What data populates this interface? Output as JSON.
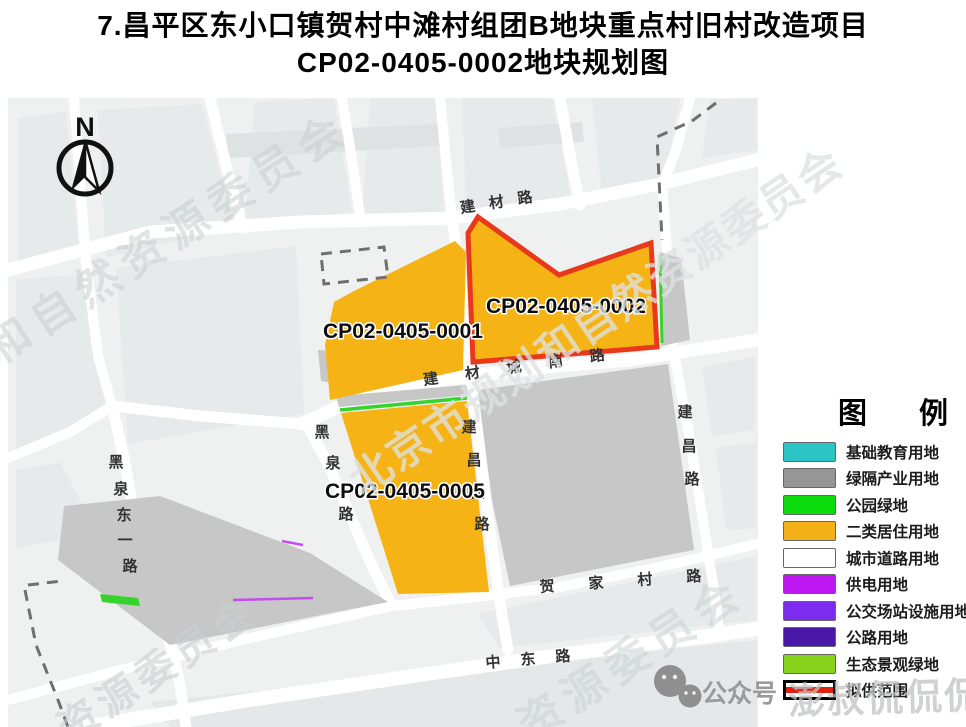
{
  "title": {
    "line1": "7.昌平区东小口镇贺村中滩村组团B地块重点村旧村改造项目",
    "line2": "CP02-0405-0002地块规划图"
  },
  "compass": {
    "north_label": "N"
  },
  "parcels": {
    "p0001": {
      "label": "CP02-0405-0001"
    },
    "p0002": {
      "label": "CP02-0405-0002"
    },
    "p0005": {
      "label": "CP02-0405-0005"
    }
  },
  "roads": {
    "jiancai": {
      "name": "建材路"
    },
    "jiancai_cheng_nan": {
      "name": "建材城南路"
    },
    "hejiacun": {
      "name": "贺家村路"
    },
    "zhongdong": {
      "name": "中东路"
    },
    "heiquan": {
      "chars": [
        "黑",
        "泉",
        "路"
      ]
    },
    "heiquan_dongyi": {
      "chars": [
        "黑",
        "泉",
        "东",
        "一",
        "路"
      ]
    },
    "jianchang_xi": {
      "chars": [
        "建",
        "昌",
        "西",
        "路"
      ]
    },
    "jianchang": {
      "chars": [
        "建",
        "昌",
        "路"
      ]
    }
  },
  "legend": {
    "title": "图 例",
    "items": [
      {
        "label": "基础教育用地",
        "color": "#2cc5c6"
      },
      {
        "label": "绿隔产业用地",
        "color": "#969696"
      },
      {
        "label": "公园绿地",
        "color": "#0cdc0c"
      },
      {
        "label": "二类居住用地",
        "color": "#f4b018"
      },
      {
        "label": "城市道路用地",
        "color": "#ffffff"
      },
      {
        "label": "供电用地",
        "color": "#bf17f2"
      },
      {
        "label": "公交场站设施用地",
        "color": "#7c2cee"
      },
      {
        "label": "公路用地",
        "color": "#4a18a8"
      },
      {
        "label": "生态景观绿地",
        "color": "#87d31d"
      },
      {
        "label": "拟供范围",
        "color": "#e02010"
      }
    ]
  },
  "map_colors": {
    "residential": "#f6b315",
    "industry": "#c7c7c7",
    "boundary_red": "#e8391d",
    "eco_green": "#35d42a",
    "power_purple": "#c44df2"
  },
  "watermarks": {
    "band_upper_left": "和自然资源委员会",
    "band_center": "北京市规划和自然资源委员会",
    "band_lower_left": "资源委员会",
    "band_lower_right": "资源委员会",
    "wechat_label": "公众号",
    "account_name": "澎叔侃侃侃"
  }
}
